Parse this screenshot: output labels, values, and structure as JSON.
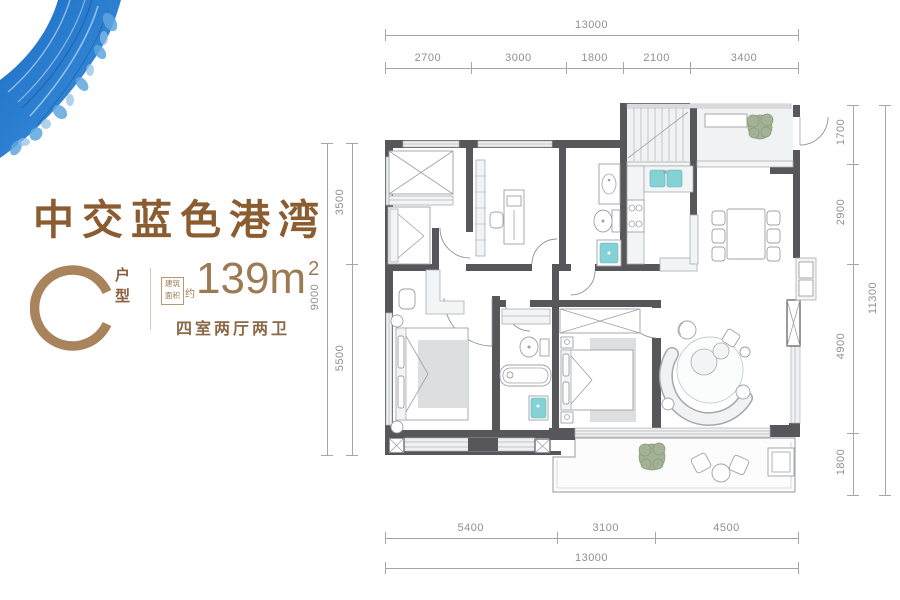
{
  "brand": {
    "title": "中交蓝色港湾"
  },
  "unit": {
    "letter": "C",
    "type_label": "户型",
    "area_box_line1": "建筑",
    "area_box_line2": "面积",
    "area_approx": "约",
    "area_value": "139m",
    "area_sup": "2",
    "rooms": "四室两厅两卫"
  },
  "dimensions": {
    "top": {
      "total": "13000",
      "segments": [
        "2700",
        "3000",
        "1800",
        "2100",
        "3400"
      ]
    },
    "bottom": {
      "total": "13000",
      "segments": [
        "5400",
        "3100",
        "4500"
      ]
    },
    "left": {
      "total": "9000",
      "segments": [
        "3500",
        "5500"
      ]
    },
    "right": {
      "total": "11300",
      "segments": [
        "1700",
        "2900",
        "4900",
        "1800"
      ]
    }
  },
  "colors": {
    "accent_brown": "#8a5c30",
    "light_brown": "#a8835c",
    "wall_gray": "#56565b",
    "fixture_teal": "#85d2d6",
    "plant_green": "#a3b295",
    "brush_blue": "#2b7fd0"
  }
}
